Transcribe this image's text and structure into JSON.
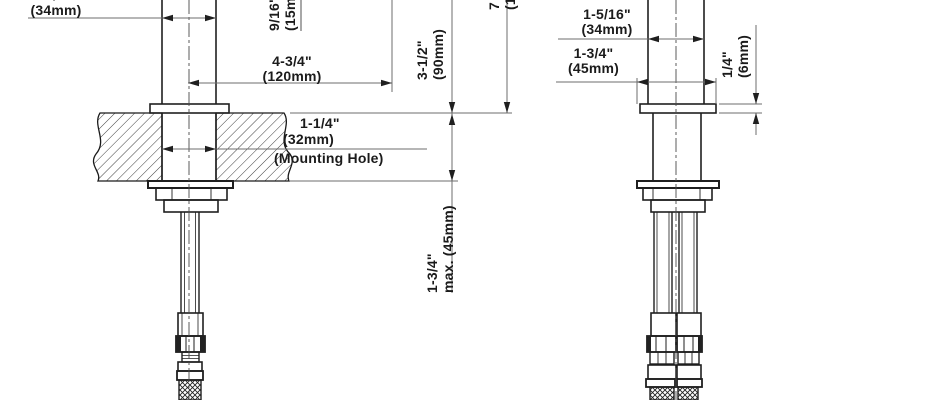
{
  "left_view": {
    "body_width": {
      "inch": "1-5/16\"",
      "mm": "(34mm)"
    },
    "spout_dim": {
      "inch": "9/16\"",
      "mm": "(15mm)"
    },
    "reach": {
      "inch": "4-3/4\"",
      "mm": "(120mm)"
    },
    "mounting_hole": {
      "inch": "1-1/4\"",
      "mm": "(32mm)",
      "note": "(Mounting Hole)"
    },
    "height_above_counter": {
      "inch": "3-1/2\"",
      "mm": "(90mm)"
    },
    "counter_thickness": {
      "inch": "1-3/4\"",
      "mm": "max. (45mm)"
    },
    "clipped_height": {
      "inch": "7",
      "mm": "(1"
    }
  },
  "right_view": {
    "body_width": {
      "inch": "1-5/16\"",
      "mm": "(34mm)"
    },
    "base_width": {
      "inch": "1-3/4\"",
      "mm": "(45mm)"
    },
    "base_height": {
      "inch": "1/4\"",
      "mm": "(6mm)"
    }
  }
}
